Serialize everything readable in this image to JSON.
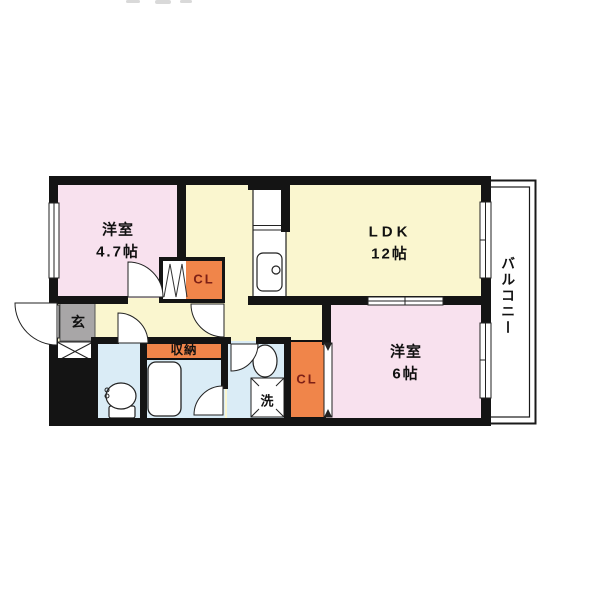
{
  "floorplan": {
    "rooms": {
      "western_small": {
        "label": "洋室",
        "size": "4.7帖"
      },
      "ldk": {
        "label": "LDK",
        "size": "12帖"
      },
      "western_large": {
        "label": "洋室",
        "size": "6帖"
      },
      "balcony": {
        "label": "バルコニー"
      },
      "entrance": {
        "label": "玄"
      },
      "storage": {
        "label": "収納"
      },
      "closet_small": {
        "label": "CL"
      },
      "closet_large": {
        "label": "CL"
      },
      "laundry": {
        "label": "洗"
      }
    },
    "colors": {
      "wall": "#141414",
      "room_pink": "#f8e1ee",
      "room_yellow": "#faf6cf",
      "room_blue": "#daecf6",
      "closet_orange": "#f0854a",
      "entrance_gray": "#a8a6a7",
      "closet_text": "#7d2016",
      "text": "#111111",
      "background": "#ffffff"
    }
  }
}
